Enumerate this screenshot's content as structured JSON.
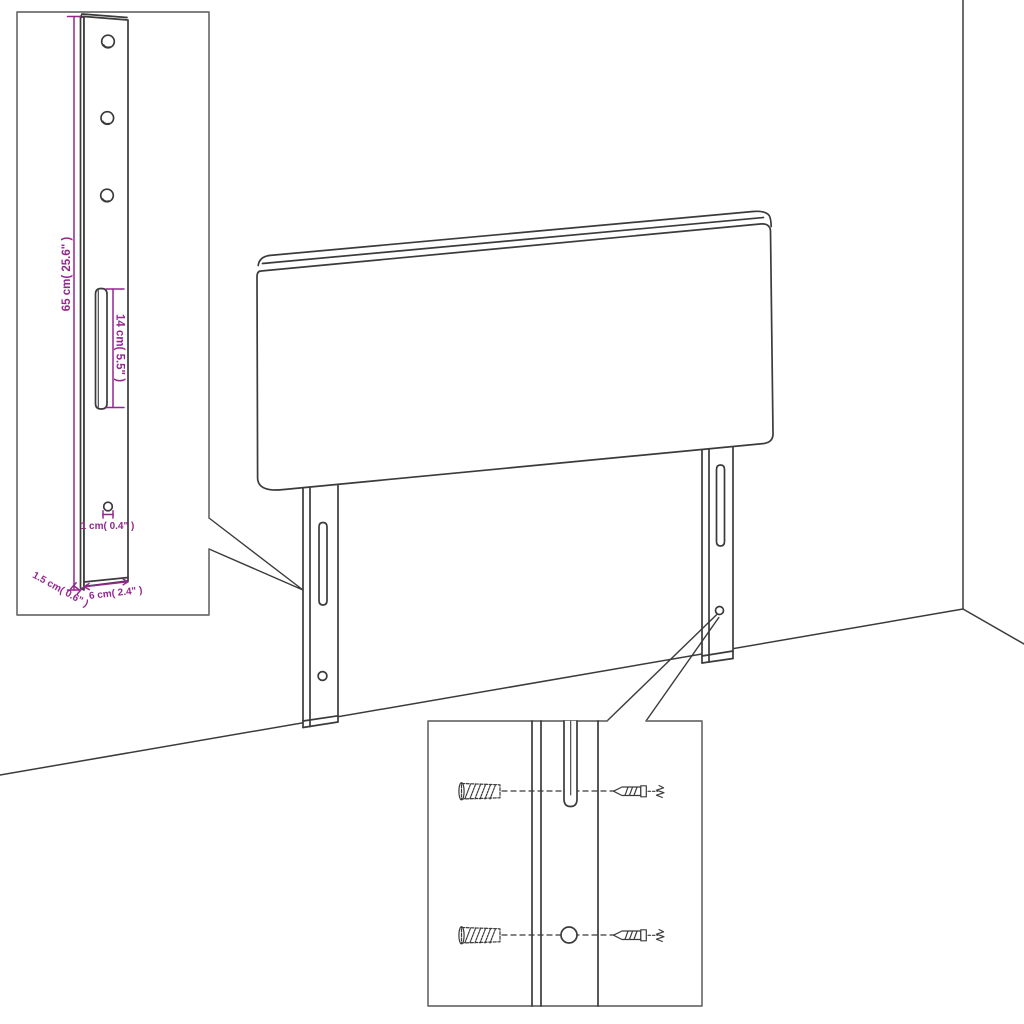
{
  "dimensions": {
    "height": "65 cm( 25.6\" )",
    "slot_length": "14 cm( 5.5\" )",
    "hole_diameter": "1 cm( 0.4\" )",
    "bracket_width": "6 cm( 2.4\" )",
    "bracket_thickness": "1.5 cm( 0.6\" )"
  },
  "colors": {
    "line": "#3b3b3b",
    "box_border": "#6f6f6f",
    "dimension": "#93278f",
    "background": "#ffffff"
  }
}
